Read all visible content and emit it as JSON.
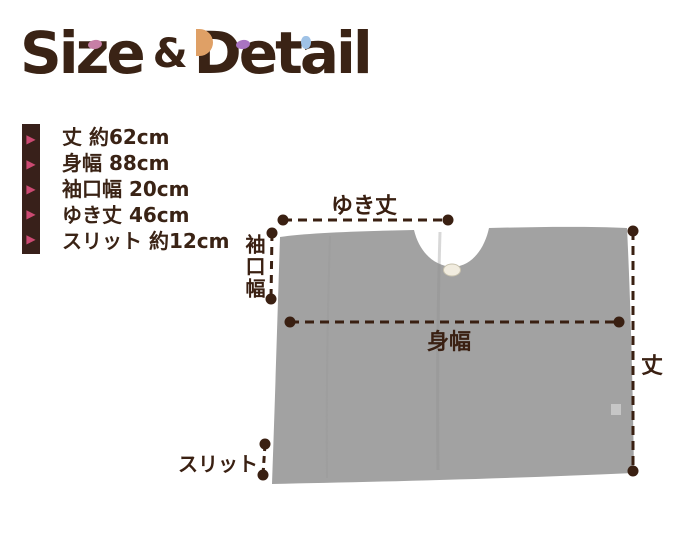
{
  "title": {
    "word1": "Size",
    "amp": "&",
    "word2": "Detail"
  },
  "title_accent_colors": {
    "pink": "#c77fa6",
    "orange": "#dfa066",
    "purple": "#a974c2",
    "blue": "#9fc2e6"
  },
  "colors": {
    "text_brown": "#3a2315",
    "line_brown": "#3a2012",
    "bullet_pink": "#cb4a72",
    "bullet_bar_brown": "#38201a",
    "garment_gray": "#a2a2a2",
    "button_cream": "#f1ecdf"
  },
  "spec": {
    "bullet_glyph": "▶",
    "items": [
      "丈 約62cm",
      "身幅 88cm",
      "袖口幅 20cm",
      "ゆき丈 46cm",
      "スリット 約12cm"
    ]
  },
  "diagram": {
    "labels": {
      "yukitake": "ゆき丈",
      "sodeguchi_haba": "袖口幅",
      "mihaba": "身幅",
      "take": "丈",
      "slit": "スリット"
    }
  }
}
